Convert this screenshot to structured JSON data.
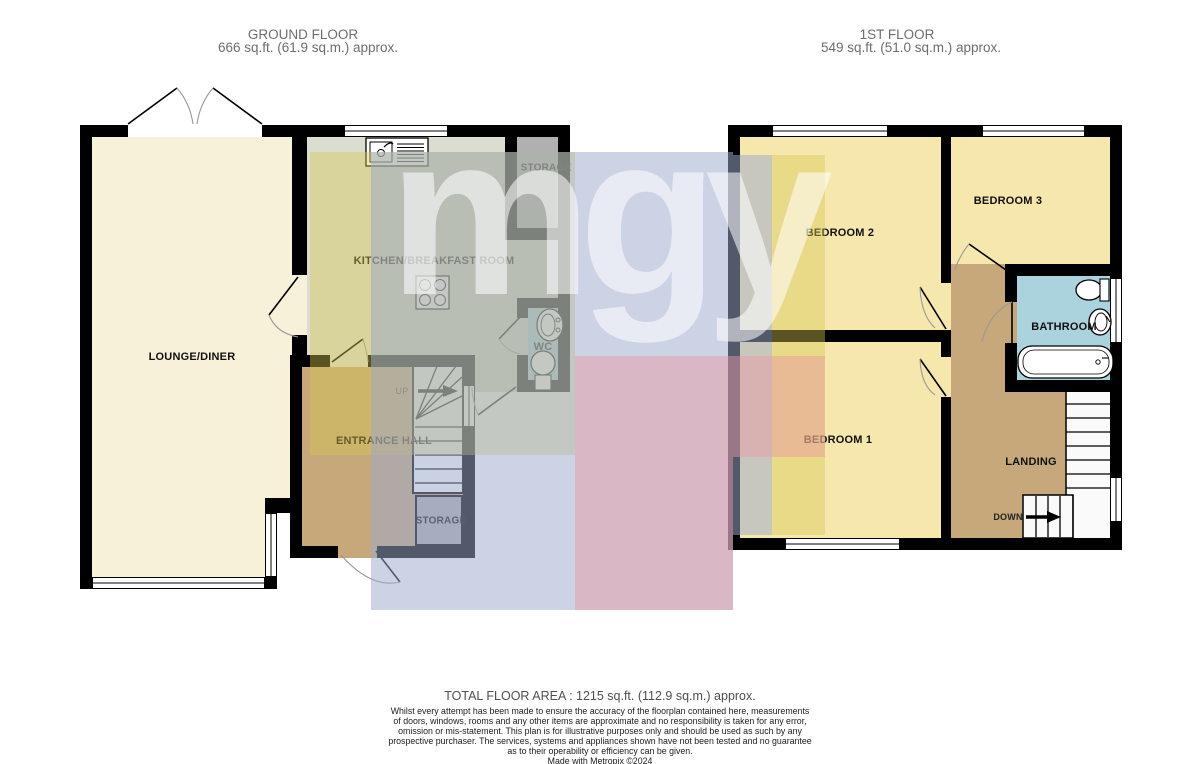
{
  "meta": {
    "width": 1200,
    "height": 764
  },
  "ground_floor": {
    "title": "GROUND FLOOR",
    "area": "666 sq.ft. (61.9 sq.m.) approx.",
    "labels": {
      "lounge": "LOUNGE/DINER",
      "kitchen": "KITCHEN/BREAKFAST ROOM",
      "hall": "ENTRANCE HALL",
      "wc": "WC",
      "storage_top": "STORAGE",
      "storage_under_stairs": "STORAGE",
      "stairs_up": "UP"
    }
  },
  "first_floor": {
    "title": "1ST FLOOR",
    "area": "549 sq.ft. (51.0 sq.m.) approx.",
    "labels": {
      "bedroom1": "BEDROOM 1",
      "bedroom2": "BEDROOM 2",
      "bedroom3": "BEDROOM 3",
      "bathroom": "BATHROOM",
      "landing": "LANDING",
      "stairs_down": "DOWN"
    }
  },
  "watermark": {
    "text": "mgy",
    "text_color": "rgba(255,255,255,0.55)",
    "block_colors": {
      "yellow": "rgba(213,200,82,0.42)",
      "blue": "rgba(158,170,205,0.52)",
      "pink": "rgba(235,152,163,0.48)"
    }
  },
  "footer": {
    "total_area": "TOTAL FLOOR AREA : 1215 sq.ft. (112.9 sq.m.) approx.",
    "disclaimer": {
      "l1": "Whilst every attempt has been made to ensure the accuracy of the floorplan contained here, measurements",
      "l2": "of doors, windows, rooms and any other items are approximate and no responsibility is taken for any error,",
      "l3": "omission or mis-statement. This plan is for illustrative purposes only and should be used as such by any",
      "l4": "prospective purchaser. The services, systems and appliances shown have not been tested and no guarantee",
      "l5": "as to their operability or efficiency can be given.",
      "credit": "Made with Metropix ©2024"
    }
  },
  "colors": {
    "wall": "#000000",
    "lounge": "#f6f1d8",
    "kitchen": "#dbddd1",
    "hall": "#c6a87b",
    "bedroom": "#f6e7ad",
    "bathroom": "#aad3de",
    "storage": "#b0b0b0",
    "stairs": "#fafafa",
    "header_text": "#6d6d6d"
  }
}
